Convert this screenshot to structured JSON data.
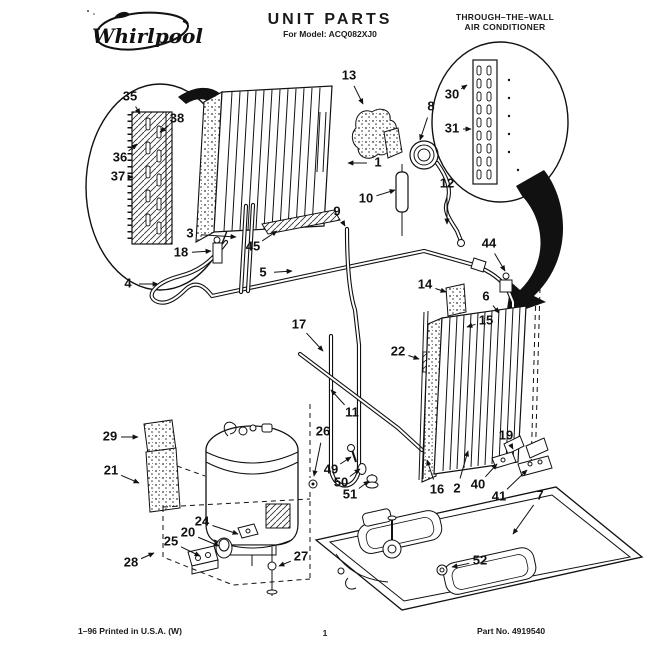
{
  "header": {
    "brand": "Whirlpool",
    "title": "UNIT PARTS",
    "model_line": "For Model: ACQ082XJ0",
    "product_line1": "THROUGH–THE–WALL",
    "product_line2": "AIR CONDITIONER"
  },
  "footer": {
    "left": "1–96 Printed in U.S.A. (W)",
    "center_page": "1",
    "right": "Part No. 4919540"
  },
  "diagram": {
    "description": "Exploded view of through-the-wall air conditioner unit parts with numbered callouts",
    "callouts": [
      {
        "n": "35",
        "x": 130,
        "y": 97,
        "tx": 140,
        "ty": 114
      },
      {
        "n": "38",
        "x": 177,
        "y": 119,
        "tx": 160,
        "ty": 132
      },
      {
        "n": "36",
        "x": 120,
        "y": 158,
        "tx": 137,
        "ty": 144
      },
      {
        "n": "37",
        "x": 118,
        "y": 177,
        "tx": 133,
        "ty": 177
      },
      {
        "n": "13",
        "x": 349,
        "y": 76,
        "tx": 363,
        "ty": 104
      },
      {
        "n": "8",
        "x": 431,
        "y": 107,
        "tx": 420,
        "ty": 140
      },
      {
        "n": "30",
        "x": 452,
        "y": 95,
        "tx": 467,
        "ty": 85
      },
      {
        "n": "31",
        "x": 452,
        "y": 129,
        "tx": 471,
        "ty": 129
      },
      {
        "n": "1",
        "x": 378,
        "y": 163,
        "tx": 348,
        "ty": 163
      },
      {
        "n": "10",
        "x": 366,
        "y": 199,
        "tx": 395,
        "ty": 190
      },
      {
        "n": "12",
        "x": 447,
        "y": 184,
        "tx": 447,
        "ty": 224
      },
      {
        "n": "9",
        "x": 337,
        "y": 212,
        "tx": 345,
        "ty": 226
      },
      {
        "n": "3",
        "x": 190,
        "y": 234,
        "tx": 236,
        "ty": 237
      },
      {
        "n": "18",
        "x": 181,
        "y": 253,
        "tx": 211,
        "ty": 251
      },
      {
        "n": "45",
        "x": 253,
        "y": 247,
        "tx": 277,
        "ty": 231
      },
      {
        "n": "5",
        "x": 263,
        "y": 273,
        "tx": 292,
        "ty": 271
      },
      {
        "n": "4",
        "x": 128,
        "y": 284,
        "tx": 158,
        "ty": 284
      },
      {
        "n": "17",
        "x": 299,
        "y": 325,
        "tx": 323,
        "ty": 351
      },
      {
        "n": "44",
        "x": 489,
        "y": 244,
        "tx": 505,
        "ty": 271
      },
      {
        "n": "14",
        "x": 425,
        "y": 285,
        "tx": 446,
        "ty": 292
      },
      {
        "n": "6",
        "x": 486,
        "y": 297,
        "tx": 499,
        "ty": 313
      },
      {
        "n": "15",
        "x": 486,
        "y": 321,
        "tx": 467,
        "ty": 327
      },
      {
        "n": "22",
        "x": 398,
        "y": 352,
        "tx": 419,
        "ty": 359
      },
      {
        "n": "11",
        "x": 352,
        "y": 413,
        "tx": 331,
        "ty": 390
      },
      {
        "n": "26",
        "x": 323,
        "y": 432,
        "tx": 314,
        "ty": 476
      },
      {
        "n": "29",
        "x": 110,
        "y": 437,
        "tx": 138,
        "ty": 437
      },
      {
        "n": "21",
        "x": 111,
        "y": 471,
        "tx": 139,
        "ty": 483
      },
      {
        "n": "19",
        "x": 506,
        "y": 436,
        "tx": 513,
        "ty": 449
      },
      {
        "n": "16",
        "x": 437,
        "y": 490,
        "tx": 427,
        "ty": 460
      },
      {
        "n": "2",
        "x": 457,
        "y": 489,
        "tx": 468,
        "ty": 451
      },
      {
        "n": "40",
        "x": 478,
        "y": 485,
        "tx": 497,
        "ty": 464
      },
      {
        "n": "41",
        "x": 499,
        "y": 497,
        "tx": 527,
        "ty": 470
      },
      {
        "n": "7",
        "x": 540,
        "y": 496,
        "tx": 513,
        "ty": 534
      },
      {
        "n": "52",
        "x": 480,
        "y": 561,
        "tx": 452,
        "ty": 567
      },
      {
        "n": "49",
        "x": 331,
        "y": 470,
        "tx": 351,
        "ty": 457
      },
      {
        "n": "50",
        "x": 341,
        "y": 483,
        "tx": 360,
        "ty": 469
      },
      {
        "n": "51",
        "x": 350,
        "y": 495,
        "tx": 369,
        "ty": 481
      },
      {
        "n": "24",
        "x": 202,
        "y": 522,
        "tx": 238,
        "ty": 534
      },
      {
        "n": "20",
        "x": 188,
        "y": 533,
        "tx": 219,
        "ty": 546
      },
      {
        "n": "25",
        "x": 171,
        "y": 542,
        "tx": 200,
        "ty": 556
      },
      {
        "n": "28",
        "x": 131,
        "y": 563,
        "tx": 154,
        "ty": 553
      },
      {
        "n": "27",
        "x": 301,
        "y": 557,
        "tx": 279,
        "ty": 566
      }
    ]
  }
}
